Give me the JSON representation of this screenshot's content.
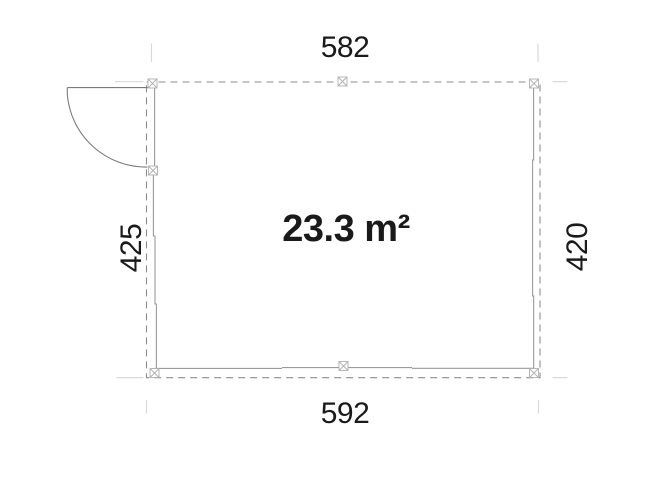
{
  "floor_plan": {
    "area_label": "23.3 m²",
    "dimensions": {
      "top": "582",
      "bottom": "592",
      "left": "425",
      "right": "420"
    },
    "symbols": {
      "post_marker": "crossed-square",
      "door": "quarter-circle-swing-arc",
      "outline": "dashed-rectangle"
    },
    "colors": {
      "label_text": "#1a1a1a",
      "outline_dash": "#8c8c8c",
      "wall_line": "#9a9a9a",
      "post_marker": "#b0b0b0",
      "door_line": "#7a7a7a",
      "extension_line": "#d9d9d9",
      "background": "#ffffff"
    }
  }
}
